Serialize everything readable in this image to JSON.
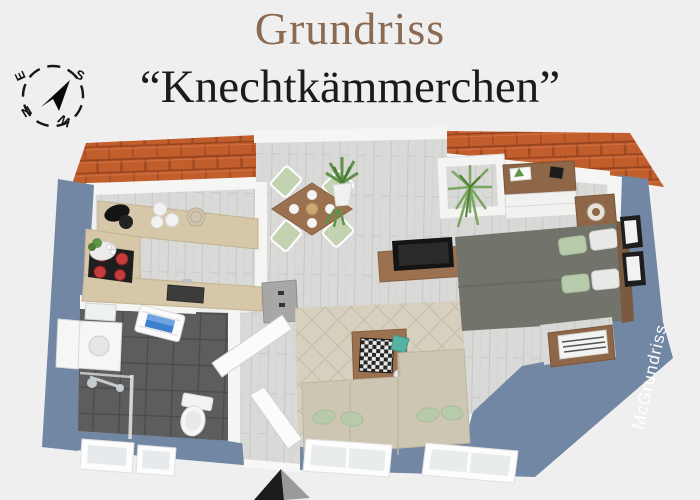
{
  "title": "Grundriss",
  "subtitle": "“Knechtkämmerchen”",
  "watermark": "McGrundriss",
  "compass": {
    "n": "N",
    "e": "E",
    "s": "S",
    "w": "W"
  },
  "colors": {
    "bg": "#efeff0",
    "title": "#8a6a52",
    "subtitle": "#1b1b1b",
    "roof": "#c25d2c",
    "roof_dark": "#93421e",
    "wall_blue": "#7287a3",
    "wall_white": "#f5f5f4",
    "floor": "#d9d9d7",
    "floor_line": "#c7c7c5",
    "counter_wood": "#d5c7a8",
    "furniture_wood": "#9b7150",
    "dark_wood": "#8d6747",
    "bath_tile": "#5d5d5d",
    "bath_tile_line": "#4b4b4b",
    "sofa": "#cdc6b2",
    "rug": "#d7d0bf",
    "rug_line": "#c3bcab",
    "pillow_green": "#b7cbaa",
    "bed_gray": "#72746c",
    "chair_green": "#c3d3b2",
    "plant_green": "#5f9349",
    "watermark_text": "#ffffff"
  }
}
